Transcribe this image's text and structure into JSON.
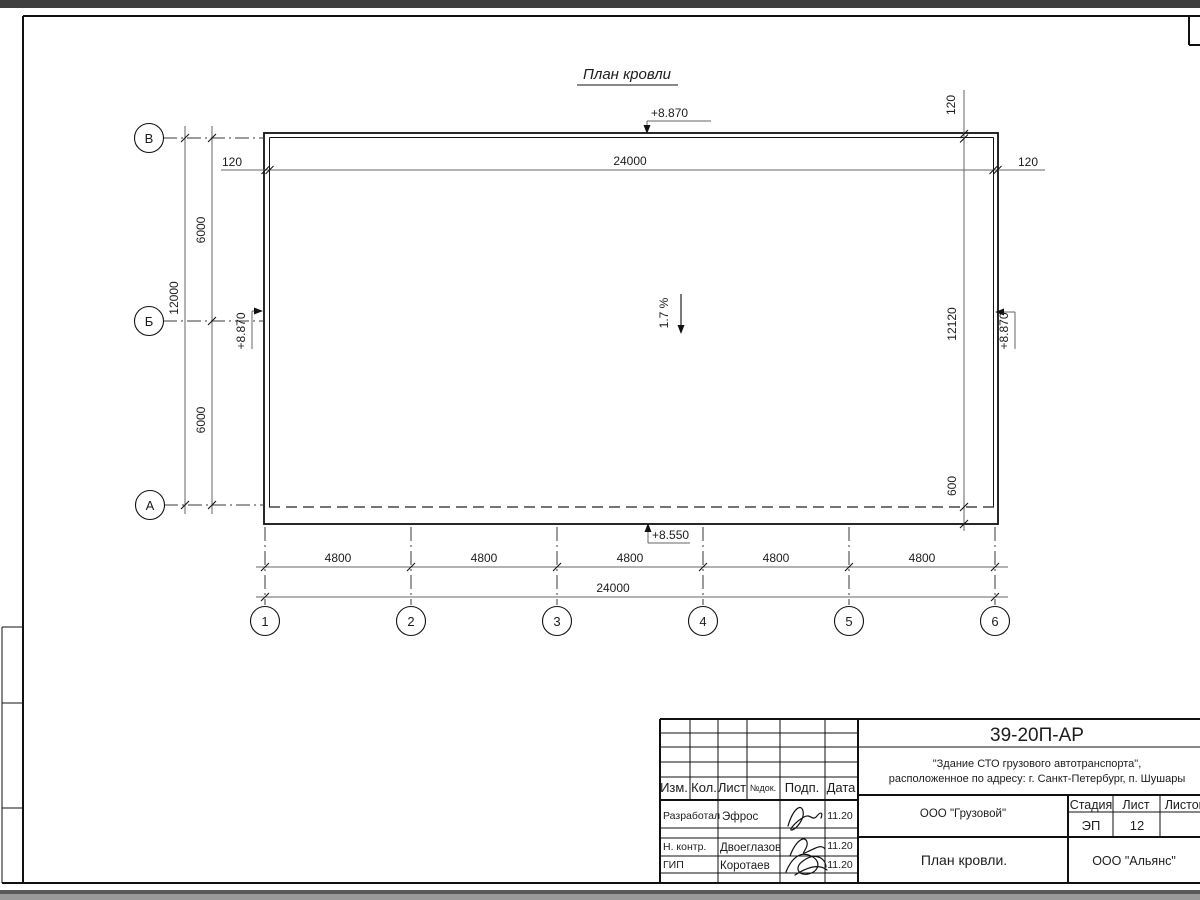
{
  "plan": {
    "title": "План кровли",
    "row_axes": [
      "В",
      "Б",
      "А"
    ],
    "col_axes": [
      "1",
      "2",
      "3",
      "4",
      "5",
      "6"
    ],
    "dims": {
      "top_left_offset": "120",
      "top_overall": "24000",
      "top_right_offset": "120",
      "right_top_offset": "120",
      "left_overall": "12000",
      "left_upper": "6000",
      "left_lower": "6000",
      "right_inner": "12120",
      "right_overhang": "600",
      "bottom_segments": [
        "4800",
        "4800",
        "4800",
        "4800",
        "4800"
      ],
      "bottom_overall": "24000"
    },
    "elevations": {
      "top": "+8.870",
      "left": "+8.870",
      "right": "+8.870",
      "bottom": "+8.550"
    },
    "slope": "1.7 %"
  },
  "titleblock": {
    "doc_code": "39-20П-АР",
    "project_line1": "\"Здание СТО грузового автотранспорта\",",
    "project_line2": "расположенное по адресу: г. Санкт-Петербург, п. Шушары",
    "columns": [
      "Изм.",
      "Кол.",
      "Лист",
      "№док.",
      "Подп.",
      "Дата"
    ],
    "rows": [
      {
        "role": "Разработал",
        "name": "Эфрос",
        "date": "11.20"
      },
      {
        "role": "Н. контр.",
        "name": "Двоеглазов",
        "date": "11.20"
      },
      {
        "role": "ГИП",
        "name": "Коротаев",
        "date": "11.20"
      }
    ],
    "client": "ООО \"Грузовой\"",
    "stage_label": "Стадия",
    "sheet_label": "Лист",
    "sheets_label": "Листов",
    "stage": "ЭП",
    "sheet": "12",
    "sheet_title": "План кровли.",
    "company": "ООО \"Альянс\""
  }
}
